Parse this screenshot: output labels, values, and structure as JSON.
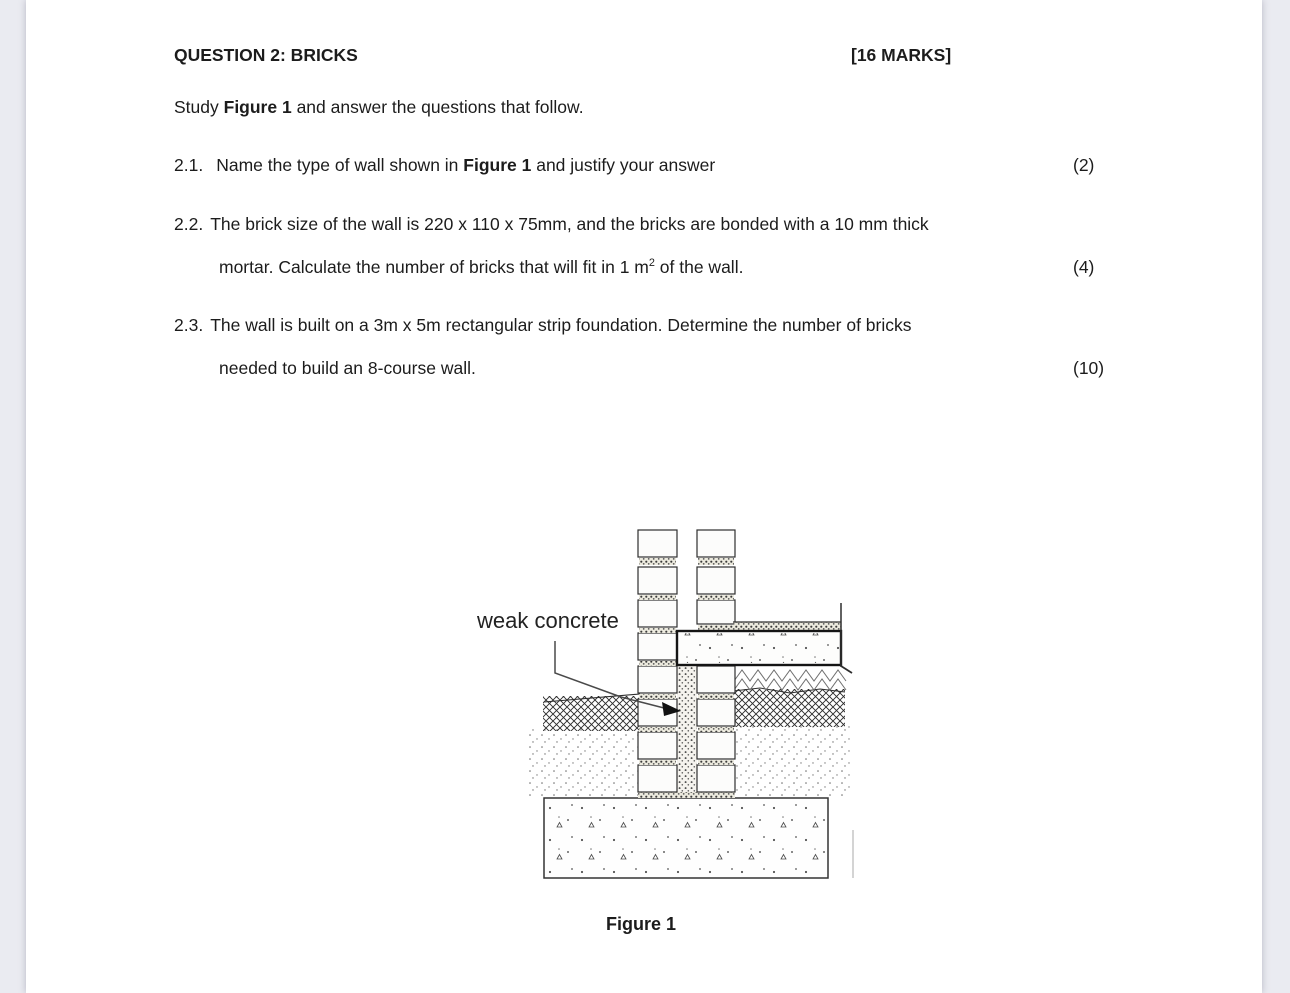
{
  "header": {
    "title": "QUESTION 2: BRICKS",
    "marks": "[16 MARKS]"
  },
  "instruction": {
    "pre": "Study ",
    "bold": "Figure 1",
    "post": " and answer the questions that follow."
  },
  "questions": [
    {
      "number": "2.1.",
      "line1_pre": "Name the type of wall shown in ",
      "line1_bold": "Figure 1",
      "line1_post": " and justify your answer",
      "marks": "(2)"
    },
    {
      "number": "2.2.",
      "line1": "The brick size of the wall is 220 x 110 x 75mm, and the bricks are bonded with a 10 mm thick",
      "line2_pre": "mortar. Calculate the number of bricks that will fit in 1 m",
      "line2_sup": "2",
      "line2_post": " of the wall.",
      "marks": "(4)"
    },
    {
      "number": "2.3.",
      "line1": "The wall is built on a 3m x 5m rectangular strip foundation. Determine the number of bricks",
      "line2": "needed to build an 8-course wall.",
      "marks": "(10)"
    }
  ],
  "figure": {
    "label": "weak concrete",
    "caption": "Figure 1"
  },
  "colors": {
    "backdrop": "#eaebf1",
    "paper": "#ffffff",
    "ink": "#1c1c1c"
  }
}
